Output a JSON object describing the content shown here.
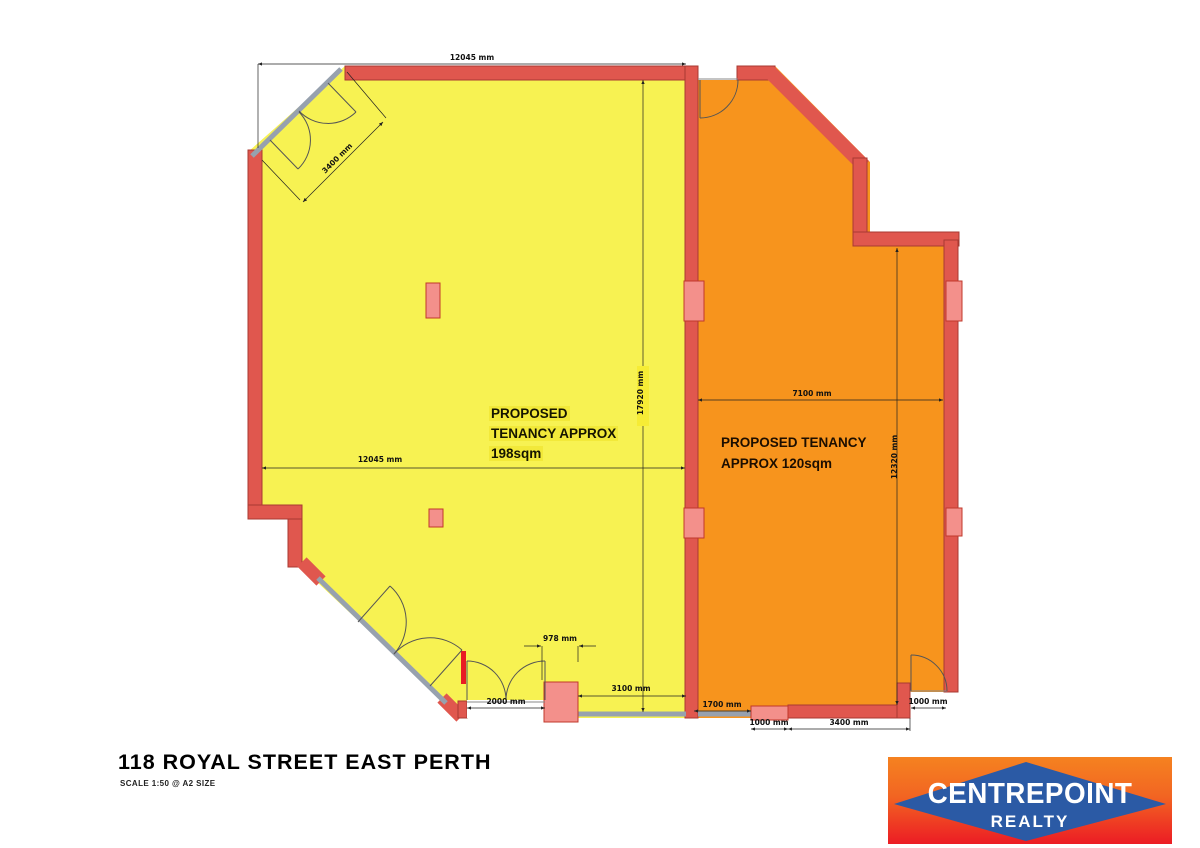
{
  "title_block": {
    "title": "118 ROYAL STREET EAST PERTH",
    "scale": "SCALE 1:50 @ A2 SIZE"
  },
  "tenancies": {
    "yellow": {
      "line1": "PROPOSED",
      "line2": "TENANCY APPROX",
      "line3": "198sqm",
      "area_sqm": 198,
      "fill": "#f7f252"
    },
    "orange": {
      "line1": "PROPOSED TENANCY",
      "line2": "APPROX 120sqm",
      "area_sqm": 120,
      "fill": "#f7941d"
    }
  },
  "dims": {
    "top_width": "12045 mm",
    "front_diagonal": "3400 mm",
    "yellow_depth": "17920 mm",
    "yellow_mid_width": "12045 mm",
    "orange_width": "7100 mm",
    "orange_depth": "12320 mm",
    "pier_width": "978 mm",
    "entry_doors": "2000 mm",
    "yellow_rear": "3100 mm",
    "orange_rear_left": "1700 mm",
    "orange_rear_pier": "1000 mm",
    "orange_rear_wall": "3400 mm",
    "orange_side_door": "1000 mm"
  },
  "logo": {
    "brand": "CENTREPOINT",
    "brand_sub": "REALTY",
    "diamond_color": "#2b5aa5",
    "gradient_top": "#f58220",
    "gradient_bottom": "#ec1c24"
  },
  "colors": {
    "wall": "#e0574e",
    "wall_edge": "#a83a32",
    "column": "#f3908b",
    "glazing": "#97a1ae",
    "accent_red": "#e81c24",
    "yellow_floor": "#f7f252",
    "orange_floor": "#f7941d"
  }
}
